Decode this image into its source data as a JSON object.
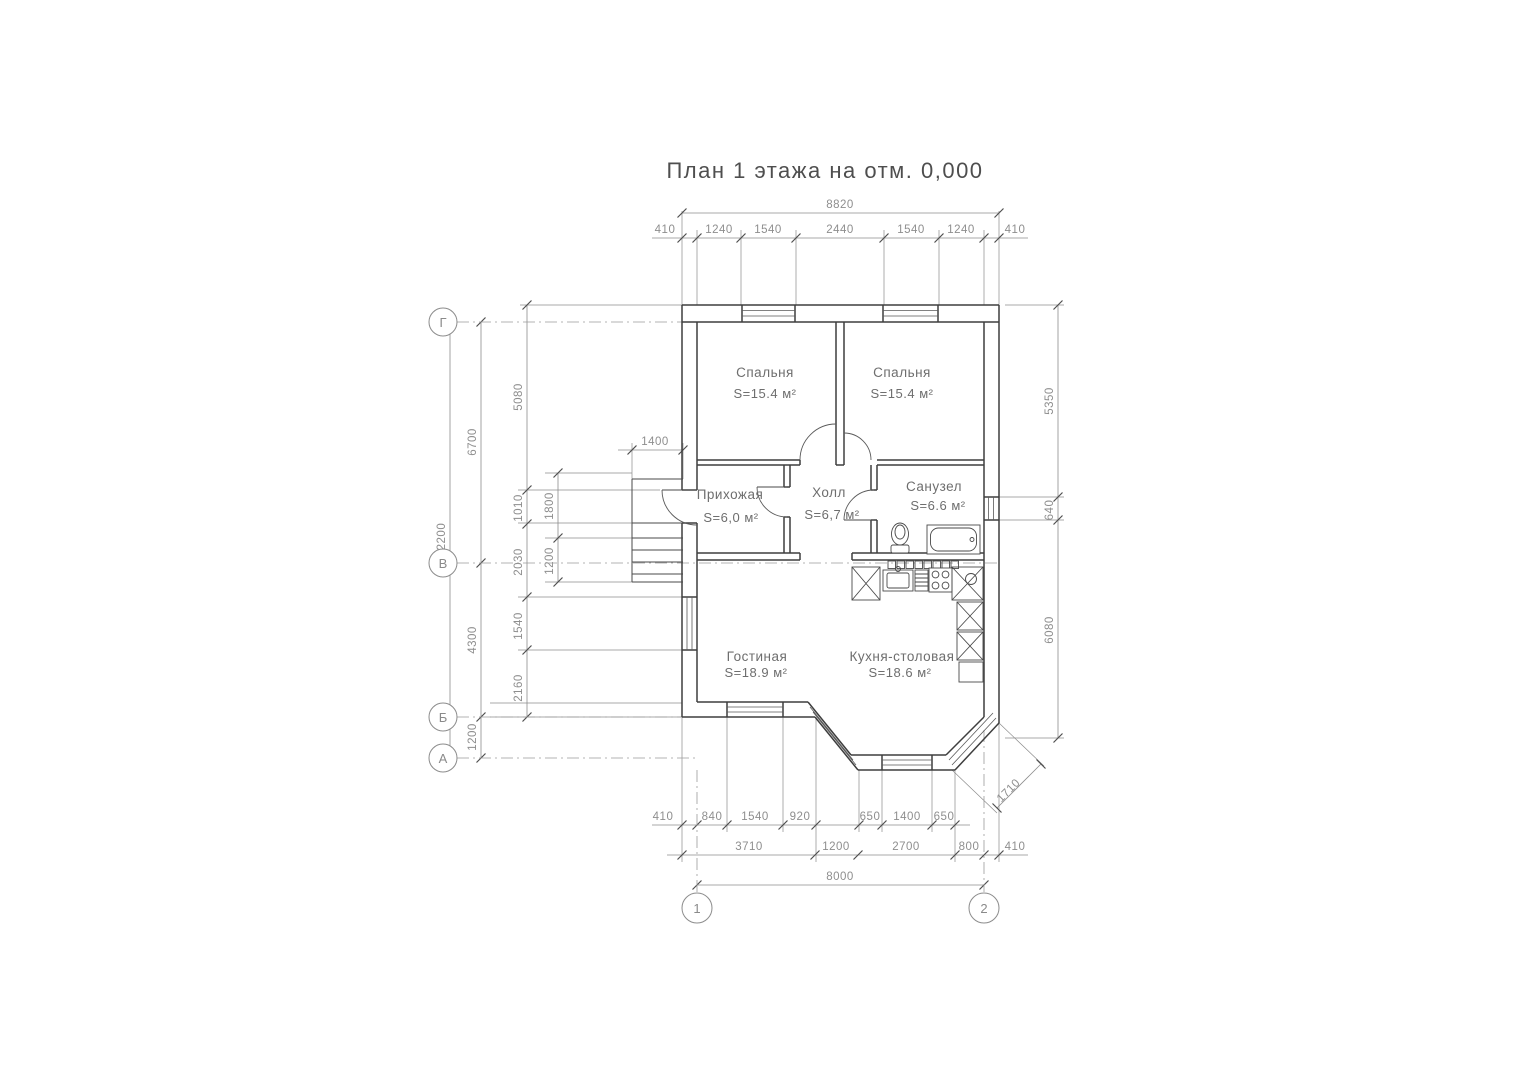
{
  "title": "План 1 этажа на отм. 0,000",
  "axes": {
    "horizontal": [
      "Г",
      "В",
      "Б",
      "А"
    ],
    "vertical": [
      "1",
      "2"
    ]
  },
  "rooms": [
    {
      "name": "Спальня",
      "area": "S=15.4 м²"
    },
    {
      "name": "Спальня",
      "area": "S=15.4 м²"
    },
    {
      "name": "Прихожая",
      "area": "S=6,0 м²"
    },
    {
      "name": "Холл",
      "area": "S=6,7 м²"
    },
    {
      "name": "Санузел",
      "area": "S=6.6 м²"
    },
    {
      "name": "Гостиная",
      "area": "S=18.9 м²"
    },
    {
      "name": "Кухня-столовая",
      "area": "S=18.6 м²"
    }
  ],
  "dimensions": {
    "top_total": "8820",
    "top_segments": [
      "410",
      "1240",
      "1540",
      "2440",
      "1540",
      "1240",
      "410"
    ],
    "bottom_row1": [
      "410",
      "840",
      "1540",
      "920",
      "650",
      "1400",
      "650"
    ],
    "bottom_row2": [
      "3710",
      "1200",
      "2700",
      "800",
      "410"
    ],
    "bottom_total": "8000",
    "left_overall": "12200",
    "left_axis_chain": [
      "6700",
      "4300",
      "1200"
    ],
    "left_wall_chain": [
      "5080",
      "1010",
      "2030",
      "1540",
      "2160"
    ],
    "stairs_chain": [
      "1800",
      "1200"
    ],
    "stairs_width": "1400",
    "right_chain": [
      "5350",
      "640",
      "6080"
    ],
    "bay_diagonal": "1710"
  }
}
